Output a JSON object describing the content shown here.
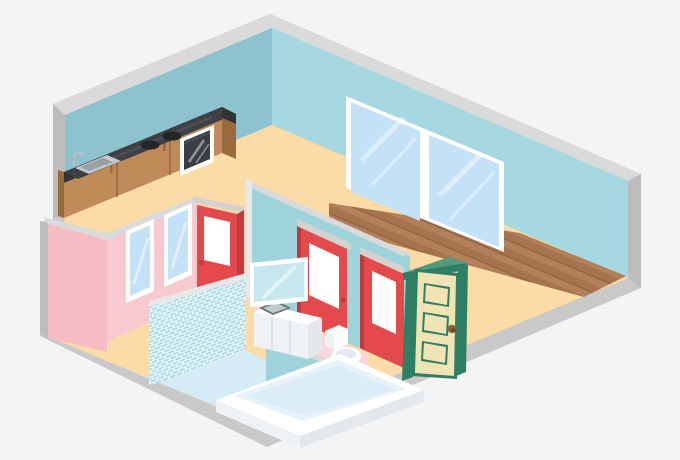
{
  "scene": {
    "type": "isometric-apartment-cutaway-illustration",
    "rooms": [
      "kitchen-living-area",
      "bathroom",
      "toilet-room",
      "hallway"
    ],
    "objects": [
      "kitchen-counter",
      "stove-burners",
      "oven",
      "kitchen-sink",
      "large-window-unit",
      "small-window",
      "red-interior-door",
      "green-entry-door",
      "tiled-shower-wall",
      "bathtub",
      "toilet",
      "vanity-sink",
      "mirror",
      "wood-floor",
      "bath-floor"
    ]
  },
  "palette": {
    "background": "#F4F4F4",
    "shellGray": "#C9C9C9",
    "shellGrayDark": "#BDBDBD",
    "capLight": "#DADADA",
    "capWhite": "#E8E8E8",
    "wallLeft": "#8DC3CE",
    "wallRight": "#A6D8E2",
    "floorTan": "#FBDCA6",
    "woodBase": "#B2805A",
    "woodDark": "#A5734E",
    "woodLine": "#966341",
    "pinkWall": "#F8C9CF",
    "pinkShade": "#F5BCC4",
    "pinkFloor": "#F8D8DC",
    "tealWall": "#9FD3DB",
    "tileTeal": "#A8DCE4",
    "tileBg": "#EDF7F8",
    "bathFloor": "#D5EBF6",
    "red": "#E4494B",
    "redDark": "#C23A3E",
    "lintelGray": "#D5D2CD",
    "white": "#FFFFFF",
    "glassBlue": "#C3E2F8",
    "mirrorGlass": "#C7E7EE",
    "greenDark": "#2E7F63",
    "greenMid": "#55997B",
    "cream": "#F1E4B4",
    "knobBrown": "#8F5D38",
    "knobDark": "#6F4527",
    "counterTop": "#3E4045",
    "counterFront": "#313236",
    "cabinetWood": "#C18B59",
    "cabinetWoodDark": "#9A6A3C",
    "steel": "#C3C9CD",
    "steelDark": "#99A1A6",
    "burnerBlack": "#232528",
    "ovenGlass": "#3A3D41",
    "fixtureWhite": "#FFFFFF",
    "fixtureShade1": "#EFF2F4",
    "fixtureShade2": "#E2E8EC",
    "tubInner": "#E7F3FA",
    "tubInner2": "#DCEDF7"
  }
}
